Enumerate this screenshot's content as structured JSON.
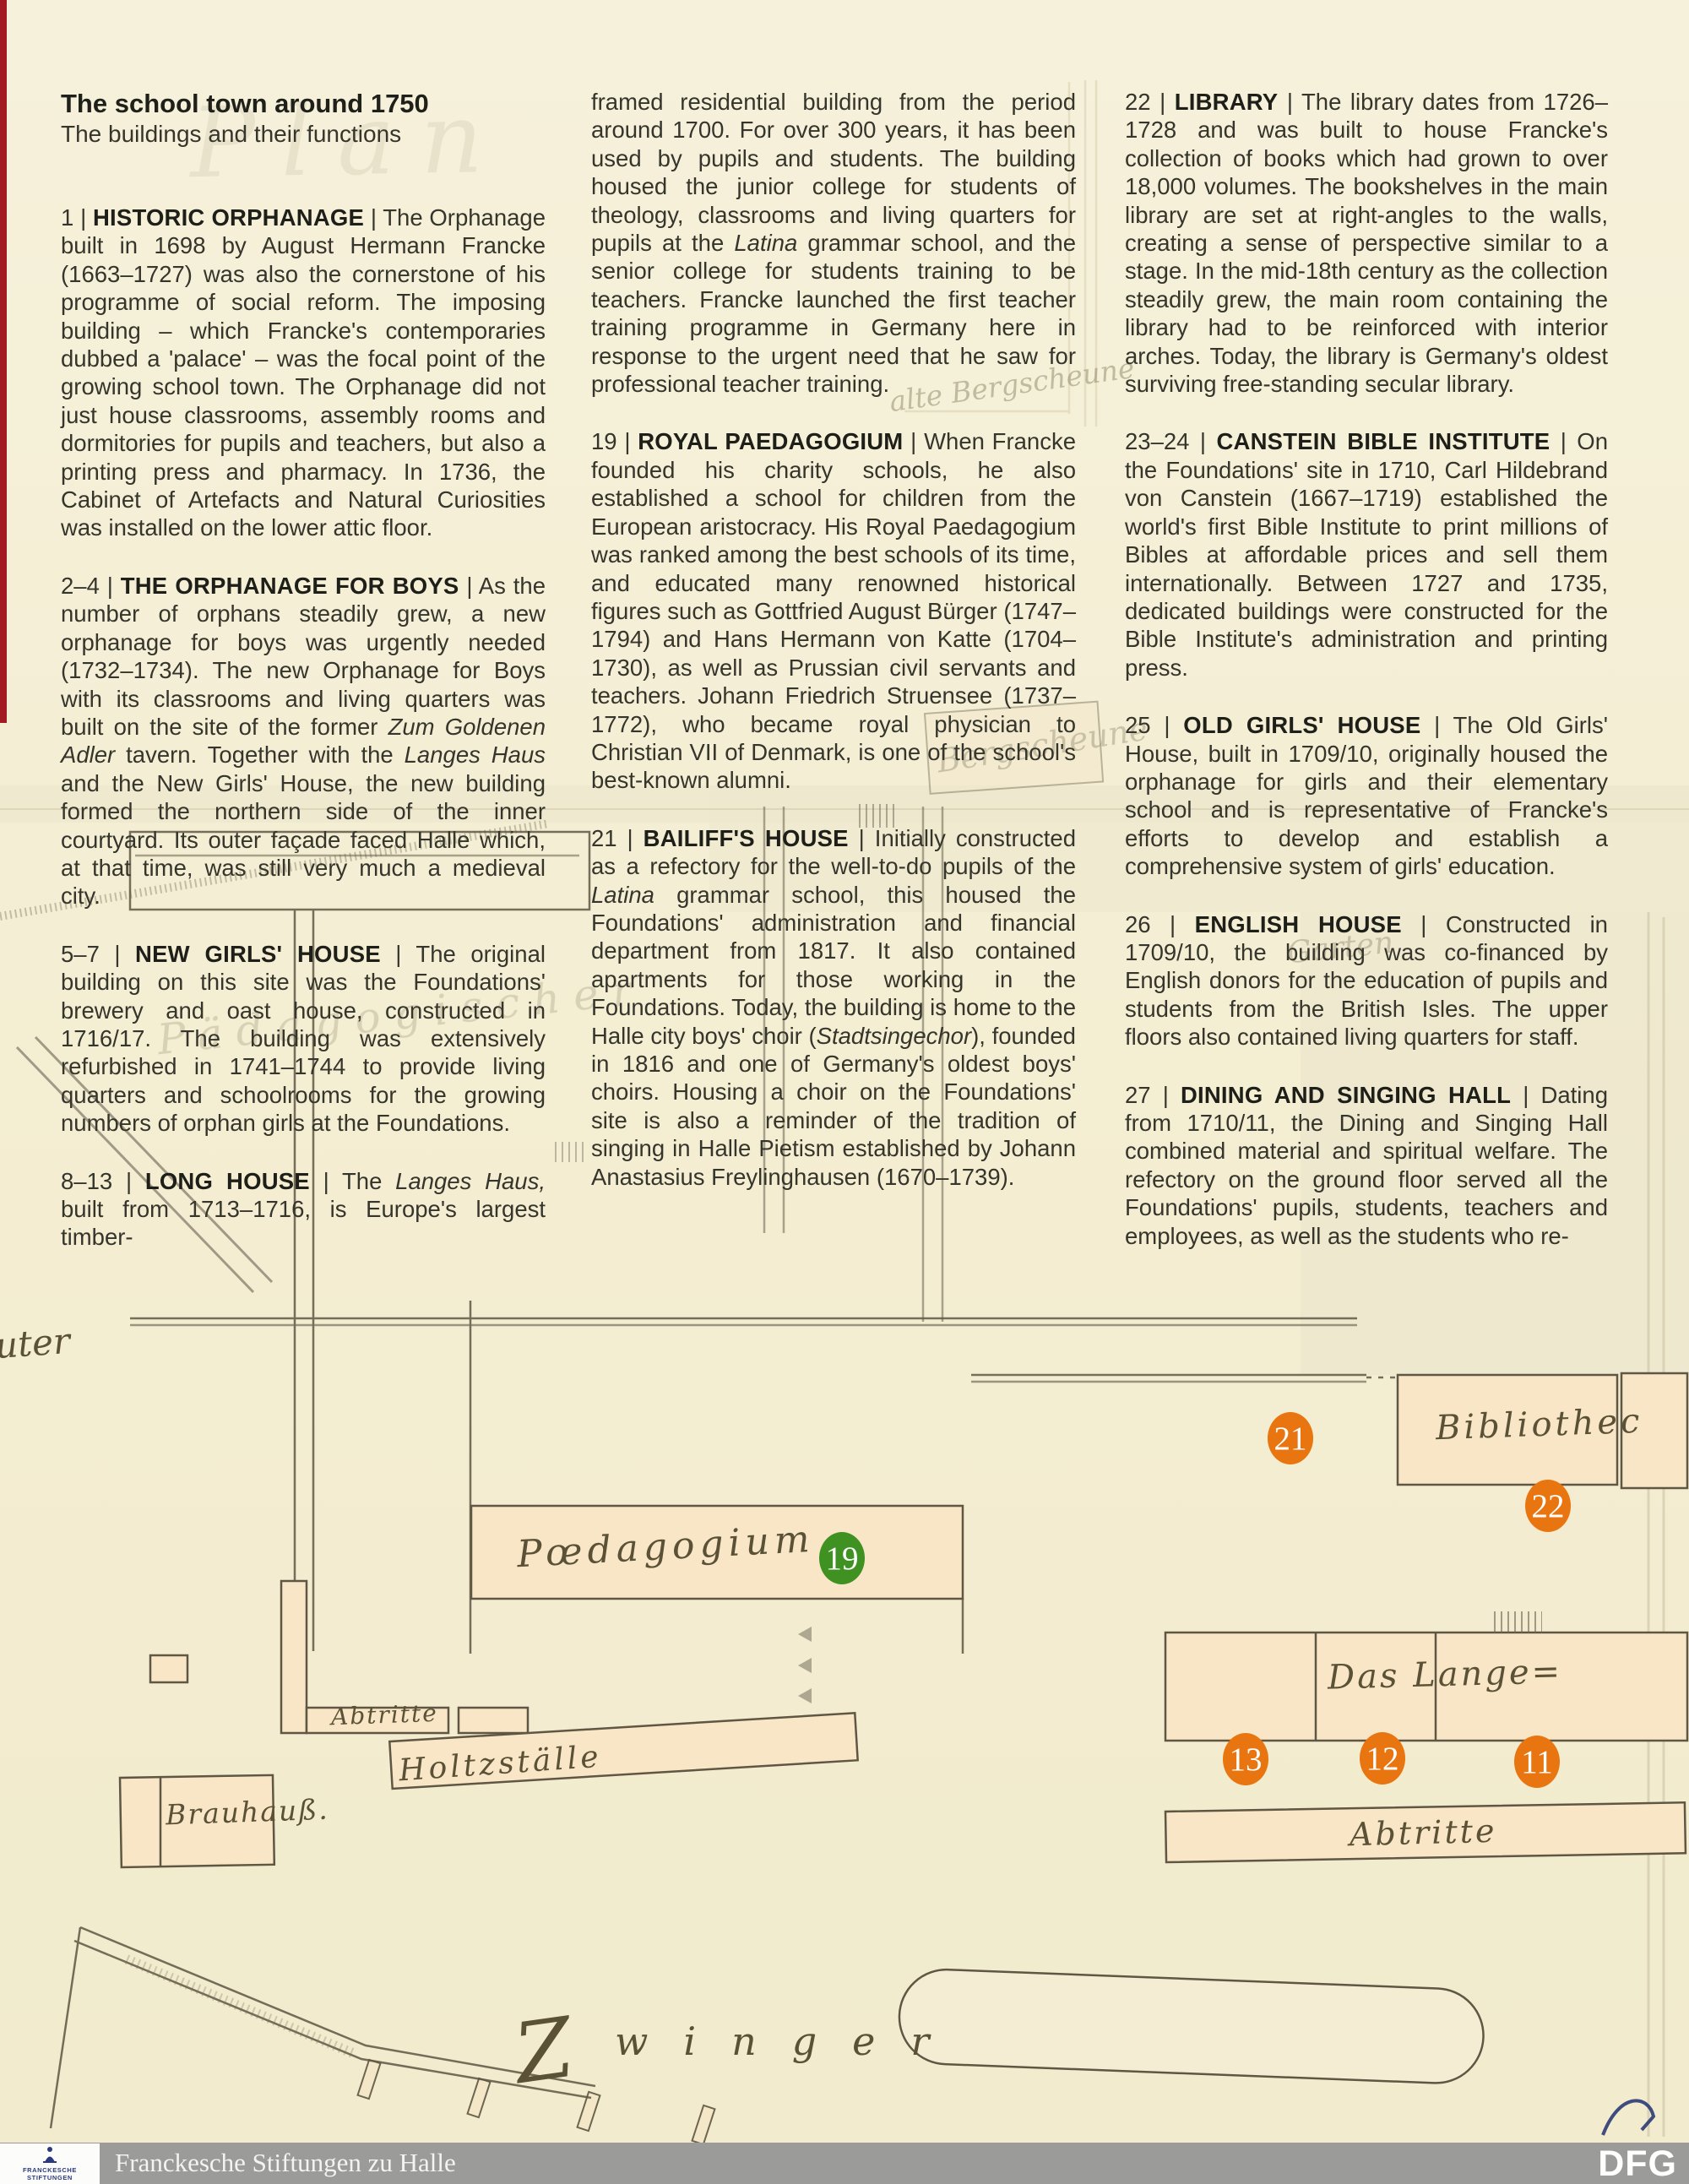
{
  "header": {
    "title": "The school town around 1750",
    "subtitle": "The buildings and their functions"
  },
  "columns": [
    {
      "sections": [
        {
          "parts": [
            {
              "k": "plain",
              "t": "1 | "
            },
            {
              "k": "bold",
              "t": "HISTORIC ORPHANAGE"
            },
            {
              "k": "plain",
              "t": " | The Orphanage built in 1698 by August Hermann Francke (1663–1727) was also the cornerstone of his programme of social reform. The imposing building – which Francke's contemporaries dubbed a 'palace' – was the focal point of the growing school town. The Orphanage did not just house classrooms, assembly rooms and dormitories for pupils and teachers, but also a printing press and pharmacy. In 1736, the Cabinet of Artefacts and Natural Curiosities was installed on the lower attic floor."
            }
          ]
        },
        {
          "parts": [
            {
              "k": "plain",
              "t": "2–4 | "
            },
            {
              "k": "bold",
              "t": "THE ORPHANAGE FOR BOYS"
            },
            {
              "k": "plain",
              "t": " | As the number of orphans steadily grew, a new orphanage for boys was urgently needed (1732–1734). The new Orphanage for Boys with its classrooms and living quarters was built on the site of the former "
            },
            {
              "k": "italic",
              "t": "Zum Goldenen Adler"
            },
            {
              "k": "plain",
              "t": " tavern. Together with the "
            },
            {
              "k": "italic",
              "t": "Langes Haus"
            },
            {
              "k": "plain",
              "t": " and the New Girls' House, the new building formed the northern side of the inner courtyard. Its outer façade faced Halle which, at that time, was still very much a medieval city."
            }
          ]
        },
        {
          "parts": [
            {
              "k": "plain",
              "t": "5–7 | "
            },
            {
              "k": "bold",
              "t": "NEW GIRLS' HOUSE"
            },
            {
              "k": "plain",
              "t": " | The original building on this site was the Foundations' brewery and oast house, constructed in 1716/17. The building was extensively refurbished in 1741–1744 to provide living quarters and schoolrooms for the growing numbers of orphan girls at the Foundations."
            }
          ]
        },
        {
          "parts": [
            {
              "k": "plain",
              "t": "8–13 | "
            },
            {
              "k": "bold",
              "t": "LONG HOUSE"
            },
            {
              "k": "plain",
              "t": " | The "
            },
            {
              "k": "italic",
              "t": "Langes Haus,"
            },
            {
              "k": "plain",
              "t": " built from 1713–1716, is Europe's largest timber-"
            }
          ]
        }
      ]
    },
    {
      "sections": [
        {
          "parts": [
            {
              "k": "plain",
              "t": "framed residential building from the period around 1700. For over 300 years, it has been used by pupils and students. The building housed the junior college for students of theology, classrooms and living quarters for pupils at the "
            },
            {
              "k": "italic",
              "t": "Latina"
            },
            {
              "k": "plain",
              "t": " grammar school, and the senior college for students training to be teachers. Francke launched the first teacher training programme in Germany here in response to the urgent need that he saw for professional teacher training."
            }
          ]
        },
        {
          "parts": [
            {
              "k": "plain",
              "t": "19 | "
            },
            {
              "k": "bold",
              "t": "ROYAL PAEDAGOGIUM"
            },
            {
              "k": "plain",
              "t": " | When Francke founded his charity schools, he also established a school for children from the European aristocracy. His Royal Paedagogium was ranked among the best schools of its time, and educated many renowned historical figures such as Gottfried August Bürger (1747–1794) and Hans Hermann von Katte (1704–1730), as well as Prussian civil servants and teachers. Johann Friedrich Struensee (1737–1772), who became royal physician to Christian VII of Denmark, is one of the school's best-known alumni."
            }
          ]
        },
        {
          "parts": [
            {
              "k": "plain",
              "t": "21 | "
            },
            {
              "k": "bold",
              "t": "BAILIFF'S HOUSE"
            },
            {
              "k": "plain",
              "t": " | Initially constructed as a refectory for the well-to-do pupils of the "
            },
            {
              "k": "italic",
              "t": "Latina"
            },
            {
              "k": "plain",
              "t": " grammar school, this housed the Foundations' administration and financial department from 1817. It also contained apartments for those working in the Foundations. Today, the building is home to the Halle city boys' choir ("
            },
            {
              "k": "italic",
              "t": "Stadtsingechor"
            },
            {
              "k": "plain",
              "t": "), founded in 1816 and one of Germany's oldest boys' choirs. Housing a choir on the Foundations' site is also a reminder of the tradition of singing in Halle Pietism established by Johann Anastasius Freylinghausen (1670–1739)."
            }
          ]
        }
      ]
    },
    {
      "sections": [
        {
          "parts": [
            {
              "k": "plain",
              "t": "22 | "
            },
            {
              "k": "bold",
              "t": "LIBRARY"
            },
            {
              "k": "plain",
              "t": " | The library dates from 1726–1728 and was built to house Francke's collection of books which had grown to over 18,000 volumes. The bookshelves in the main library are set at right-angles to the walls, creating a sense of perspective similar to a stage. In the mid-18th century as the collection steadily grew, the main room containing the library had to be reinforced with interior arches. Today, the library is Germany's oldest surviving free-standing secular library."
            }
          ]
        },
        {
          "parts": [
            {
              "k": "plain",
              "t": "23–24 | "
            },
            {
              "k": "bold",
              "t": "CANSTEIN BIBLE INSTITUTE"
            },
            {
              "k": "plain",
              "t": " | On the Foundations' site in 1710, Carl Hildebrand von Canstein (1667–1719) established the world's first Bible Institute to print millions of Bibles at affordable prices and sell them internationally. Between 1727 and 1735, dedicated buildings were constructed for the Bible Institute's administration and printing press."
            }
          ]
        },
        {
          "parts": [
            {
              "k": "plain",
              "t": "25 | "
            },
            {
              "k": "bold",
              "t": "OLD GIRLS' HOUSE"
            },
            {
              "k": "plain",
              "t": " | The Old Girls' House, built in 1709/10, originally housed the orphanage for girls and their elementary school and is representative of Francke's efforts to develop and establish a comprehensive system of girls' education."
            }
          ]
        },
        {
          "parts": [
            {
              "k": "plain",
              "t": "26 | "
            },
            {
              "k": "bold",
              "t": "ENGLISH HOUSE"
            },
            {
              "k": "plain",
              "t": " | Constructed in 1709/10, the building was co-financed by English donors for the education of pupils and students from the British Isles. The upper floors also contained living quarters for staff."
            }
          ]
        },
        {
          "parts": [
            {
              "k": "plain",
              "t": "27 | "
            },
            {
              "k": "bold",
              "t": "DINING AND SINGING HALL"
            },
            {
              "k": "plain",
              "t": " | Dating from 1710/11, the Dining and Singing Hall combined material and spiritual welfare. The refectory on the ground floor served all the Foundations' pupils, students, teachers and employees, as well as the students who re-"
            }
          ]
        }
      ]
    }
  ],
  "map": {
    "labels": {
      "bibliothec": "Bibliothec",
      "paedagogium": "Pœdagogium",
      "das_lange": "Das Lange=",
      "abtritte_right": "Abtritte",
      "abtritte_left": "Abtritte",
      "holtzstaelle": "Holtzställe",
      "brauhauss": "Brauhauß.",
      "zwinger_initial": "Z",
      "zwinger_rest": "winger",
      "edge_fragment": "uter"
    },
    "faint_handwriting": {
      "plan": "Plan",
      "bergscheune_small": "alte Bergscheune",
      "bergscheune_large": "Bergscheune",
      "paedagogischer": "Pädagogischer",
      "garten": "Garten"
    },
    "markers": [
      {
        "num": "19",
        "color": "green"
      },
      {
        "num": "21",
        "color": "orange"
      },
      {
        "num": "22",
        "color": "orange"
      },
      {
        "num": "13",
        "color": "orange"
      },
      {
        "num": "12",
        "color": "orange"
      },
      {
        "num": "11",
        "color": "orange"
      }
    ]
  },
  "footer": {
    "logo_line1": "FRANCKESCHE",
    "logo_line2": "STIFTUNGEN",
    "organization": "Franckesche Stiftungen zu Halle",
    "dfg": "DFG"
  },
  "colors": {
    "marker_orange": "#E8750F",
    "marker_green": "#3F9222",
    "paper": "#F4EED4",
    "ink": "#35352C",
    "map_building": "#F8E6C6",
    "map_line": "#5F5744",
    "footer_bar": "#9B9B99"
  }
}
